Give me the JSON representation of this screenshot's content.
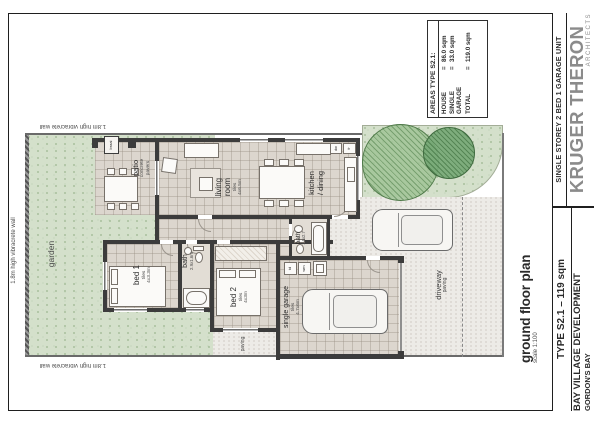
{
  "palette": {
    "paper": "#ffffff",
    "wall_dark": "#3c3c3c",
    "floor_tile": "#dcd6ce",
    "garden_green": "#d4e0cb",
    "tree_green_light": "#a0c396",
    "tree_green_dark": "#78aa78",
    "paving_gray": "#edebe7",
    "brand_gray": "#8b8b8b",
    "ink": "#2b2b2b"
  },
  "title_block": {
    "project_type": "SINGLE STOREY 2 BED 1 GARAGE UNIT",
    "firm_name": "KRUGER THERON",
    "firm_subtitle": "ARCHITECTS",
    "unit_type": "TYPE S2.1 – 119 sqm",
    "development": "BAY VILLAGE DEVELOPMENT",
    "location": "GORDON'S BAY"
  },
  "areas_table": {
    "header": "AREAS TYPE S2.1:",
    "eq": "=",
    "rows": [
      {
        "label": "HOUSE",
        "value": "86.0 sqm"
      },
      {
        "label": "SINGLE GARAGE",
        "value": "33.0 sqm"
      },
      {
        "label": "TOTAL",
        "value": "119.0 sqm"
      }
    ]
  },
  "drawing_title": {
    "title": "ground floor plan",
    "scale": "scale 1:100"
  },
  "site": {
    "wall_label_left": "1.8m high vibracrete wall",
    "wall_label_top": "1.8m high vibracrete wall",
    "wall_label_bottom": "1.8m high vibracrete wall",
    "garden": "garden",
    "paving_strip": "paving",
    "driveway_name": "driveway",
    "driveway_finish": "paving"
  },
  "rooms": {
    "patio": {
      "name": "patio",
      "finish_l1": "concrete",
      "finish_l2": "pavers"
    },
    "braai": {
      "name": "braai"
    },
    "living": {
      "l1": "living",
      "l2": "room",
      "finish": "tiles",
      "size": "4x6.5m"
    },
    "kitchen": {
      "l1": "kitchen",
      "l2": "/ dining"
    },
    "bed1": {
      "name": "bed 1",
      "finish": "tiles",
      "size": "4x3.3m"
    },
    "bath1": {
      "name": "bath",
      "size": "2.9x1.6m"
    },
    "bed2": {
      "name": "bed 2",
      "finish": "tiles",
      "size": "4x3m"
    },
    "bath2": {
      "name": "bath",
      "size": "1.6x2.7"
    },
    "garage": {
      "name": "single garage",
      "finish": "tiles",
      "size": "4.7x6m"
    },
    "appliances": {
      "dishwasher": "dw",
      "fridge": "fr",
      "tumble_dryer": "td",
      "washing_machine": "wm"
    }
  }
}
